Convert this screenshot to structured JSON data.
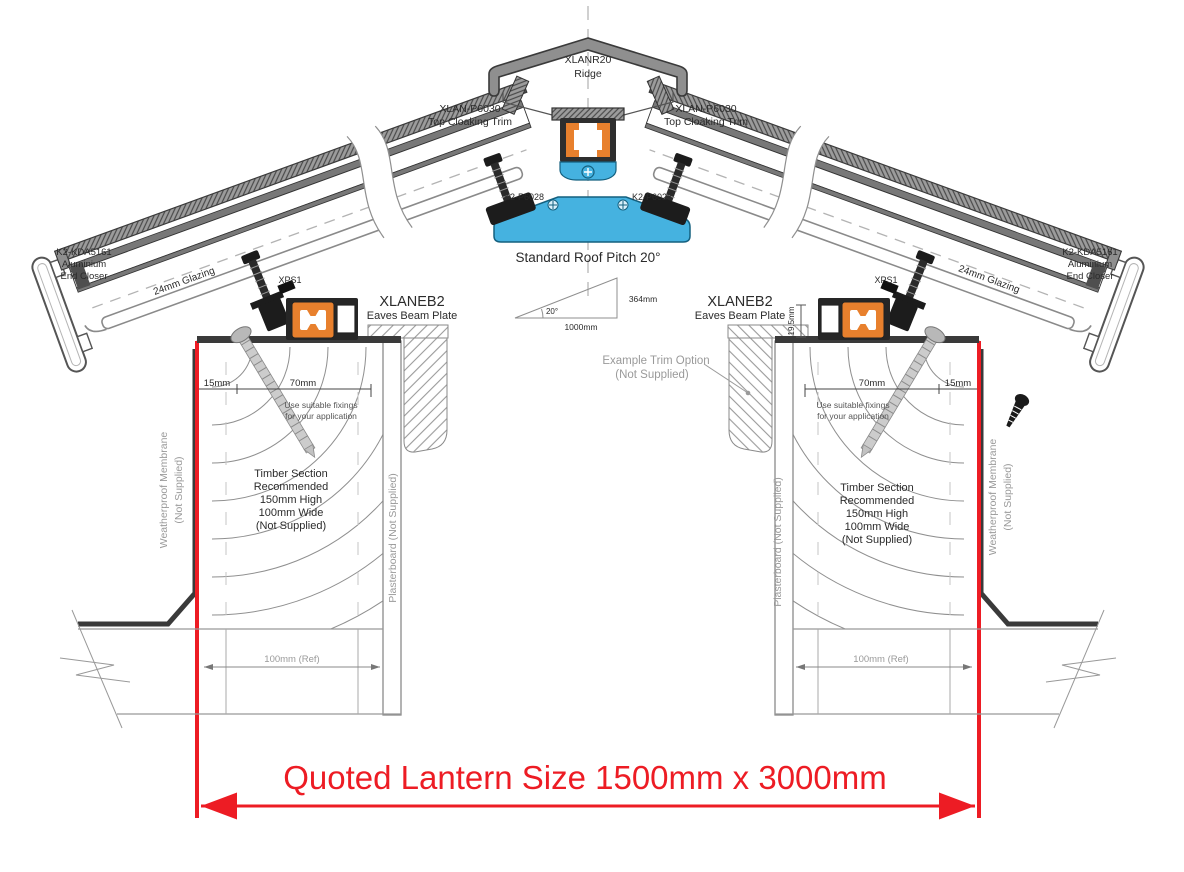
{
  "drawing": {
    "title": "Roof lantern cross-section installation drawing",
    "ridge": {
      "part": "XLANR20",
      "name": "Ridge"
    },
    "cloaking_trim": {
      "part": "XLAN-P6030",
      "name": "Top Cloaking Trim"
    },
    "ridge_clamp": {
      "part": "K2-P6028"
    },
    "pitch": {
      "label": "Standard Roof Pitch 20°",
      "angle": "20°",
      "run": "1000mm",
      "rise": "364mm"
    },
    "eaves_beam": {
      "part": "XLANEB2",
      "name": "Eaves Beam Plate",
      "height_dim": "19.5mm"
    },
    "spacer": {
      "part": "XPS1"
    },
    "glazing": {
      "label": "24mm Glazing"
    },
    "end_closer": {
      "part": "K2-KDA5161",
      "line2": "Aluminium",
      "line3": "End Closer"
    },
    "dims": {
      "edge": "15mm",
      "fixing": "70mm",
      "wall_ref": "100mm (Ref)"
    },
    "fixings_note": {
      "line1": "Use suitable fixings",
      "line2": "for your application"
    },
    "trim_option": {
      "line1": "Example Trim Option",
      "line2": "(Not Supplied)"
    },
    "timber_note": [
      "Timber Section",
      "Recommended",
      "150mm High",
      "100mm Wide",
      "(Not Supplied)"
    ],
    "membrane": {
      "line1": "Weatherproof Membrane",
      "line2": "(Not Supplied)"
    },
    "plasterboard": {
      "label": "Plasterboard (Not Supplied)"
    },
    "quoted_size": "Quoted Lantern Size 1500mm x 3000mm"
  },
  "colors": {
    "accent_red": "#ed1c24",
    "profile_orange": "#e8802d",
    "profile_blue": "#45b2e0",
    "metal_gray": "#8f8f8f",
    "line_dark": "#3a3a3a",
    "note_gray": "#9a9a9a"
  }
}
